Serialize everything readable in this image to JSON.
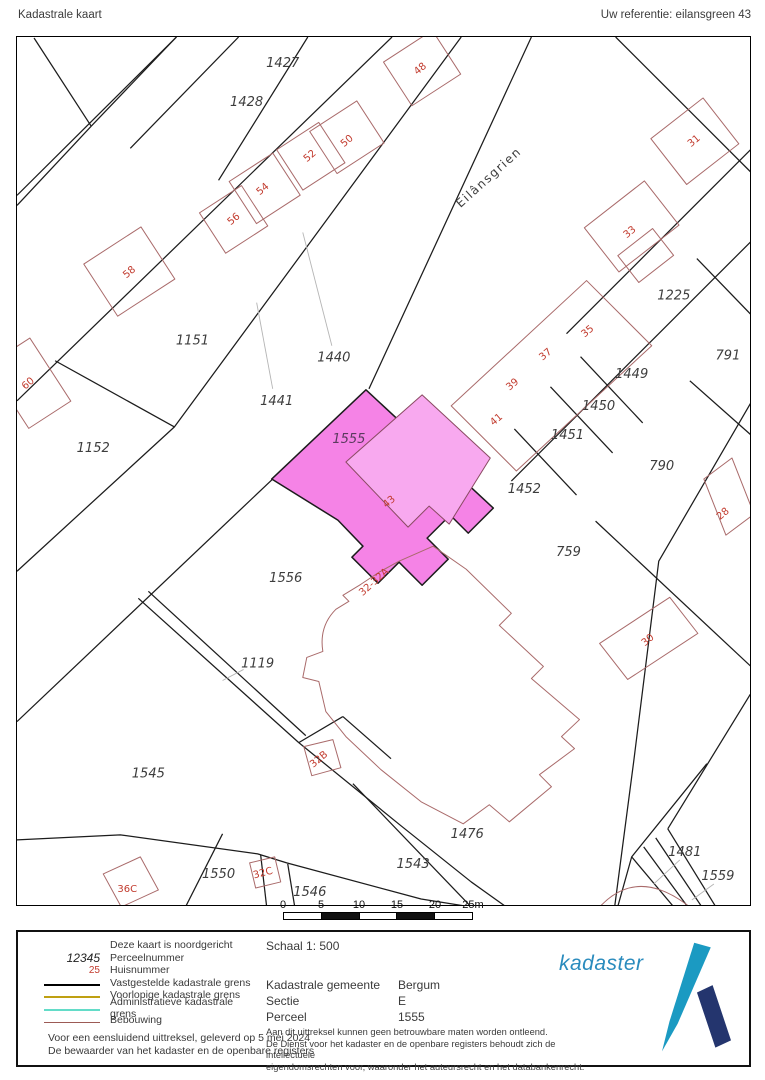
{
  "header": {
    "title": "Kadastrale kaart",
    "reference": "Uw referentie: eilansgreen 43"
  },
  "scalebar": {
    "ticks": [
      "0",
      "5",
      "10",
      "15",
      "20",
      "25m"
    ]
  },
  "legend": {
    "north_note": "Deze kaart is noordgericht",
    "perceel_sample": "12345",
    "perceel_label": "Perceelnummer",
    "huis_sample": "25",
    "huis_label": "Huisnummer",
    "line_items": [
      {
        "label": "Vastgestelde kadastrale grens",
        "color": "#000000"
      },
      {
        "label": "Voorlopige kadastrale grens",
        "color": "#bfa012"
      },
      {
        "label": "Administratieve kadastrale grens",
        "color": "#63dcc8"
      },
      {
        "label": "Bebouwing",
        "color": "#9c5a55"
      }
    ],
    "footer_line1": "Voor een eensluidend uittreksel, geleverd op 5 mei 2024",
    "footer_line2": "De bewaarder van het kadaster en de openbare registers",
    "schaal": "Schaal 1: 500",
    "info_rows": [
      {
        "label": "Kadastrale gemeente",
        "value": "Bergum"
      },
      {
        "label": "Sectie",
        "value": "E"
      },
      {
        "label": "Perceel",
        "value": "1555"
      }
    ],
    "disclaimer": [
      "Aan dit uittreksel kunnen geen betrouwbare maten worden ontleend.",
      "De Dienst voor het kadaster en de openbare registers behoudt zich de intellectuele",
      "eigendomsrechten voor, waaronder het auteursrecht en het databankenrecht."
    ],
    "logo_text": "kadaster"
  },
  "map": {
    "street": {
      "text": "Eilânsgrien",
      "x": 490,
      "y": 180,
      "rot": -42
    },
    "highlight_parcel": "1555",
    "colors": {
      "highlight_fill": "#f583e6",
      "highlight_building_fill": "#f8a9ef",
      "building_line": "#a96a6a",
      "boundary_line": "#1c1c1c",
      "house_number": "#c23b2e",
      "parcel_label": "#3d3d3d"
    },
    "parcel_labels": [
      {
        "text": "1427",
        "x": 282,
        "y": 67
      },
      {
        "text": "1428",
        "x": 246,
        "y": 106
      },
      {
        "text": "1225",
        "x": 672,
        "y": 299
      },
      {
        "text": "791",
        "x": 726,
        "y": 359
      },
      {
        "text": "1151",
        "x": 192,
        "y": 344
      },
      {
        "text": "1440",
        "x": 333,
        "y": 361
      },
      {
        "text": "1441",
        "x": 276,
        "y": 404
      },
      {
        "text": "1449",
        "x": 630,
        "y": 377
      },
      {
        "text": "1450",
        "x": 597,
        "y": 409
      },
      {
        "text": "1451",
        "x": 566,
        "y": 438
      },
      {
        "text": "1452",
        "x": 523,
        "y": 492
      },
      {
        "text": "790",
        "x": 660,
        "y": 469
      },
      {
        "text": "759",
        "x": 567,
        "y": 555
      },
      {
        "text": "1152",
        "x": 93,
        "y": 451
      },
      {
        "text": "1555",
        "x": 348,
        "y": 442,
        "cls": "sel"
      },
      {
        "text": "1556",
        "x": 285,
        "y": 581
      },
      {
        "text": "1119",
        "x": 257,
        "y": 666
      },
      {
        "text": "1545",
        "x": 148,
        "y": 776
      },
      {
        "text": "1476",
        "x": 466,
        "y": 836
      },
      {
        "text": "1543",
        "x": 412,
        "y": 866
      },
      {
        "text": "1550",
        "x": 218,
        "y": 876
      },
      {
        "text": "1546",
        "x": 309,
        "y": 894
      },
      {
        "text": "1481",
        "x": 683,
        "y": 854
      },
      {
        "text": "1559",
        "x": 716,
        "y": 878
      }
    ],
    "house_numbers": [
      {
        "text": "48",
        "x": 421,
        "y": 71,
        "rot": -40
      },
      {
        "text": "50",
        "x": 348,
        "y": 143,
        "rot": -40
      },
      {
        "text": "52",
        "x": 311,
        "y": 158,
        "rot": -40
      },
      {
        "text": "54",
        "x": 264,
        "y": 191,
        "rot": -40
      },
      {
        "text": "56",
        "x": 235,
        "y": 221,
        "rot": -40
      },
      {
        "text": "58",
        "x": 131,
        "y": 274,
        "rot": -40
      },
      {
        "text": "31",
        "x": 694,
        "y": 143,
        "rot": -40
      },
      {
        "text": "33",
        "x": 630,
        "y": 234,
        "rot": -40
      },
      {
        "text": "35",
        "x": 588,
        "y": 333,
        "rot": -40
      },
      {
        "text": "37",
        "x": 546,
        "y": 356,
        "rot": -40
      },
      {
        "text": "39",
        "x": 513,
        "y": 386,
        "rot": -40
      },
      {
        "text": "41",
        "x": 497,
        "y": 421,
        "rot": -40
      },
      {
        "text": "60",
        "x": 30,
        "y": 385,
        "rot": -40
      },
      {
        "text": "28",
        "x": 723,
        "y": 515,
        "rot": -40
      },
      {
        "text": "43",
        "x": 390,
        "y": 503,
        "rot": -40
      },
      {
        "text": "30",
        "x": 648,
        "y": 641,
        "rot": -40
      },
      {
        "text": "32-32A",
        "x": 375,
        "y": 583,
        "rot": -42
      },
      {
        "text": "32B",
        "x": 320,
        "y": 760,
        "rot": -40
      },
      {
        "text": "36C",
        "x": 127,
        "y": 890,
        "rot": 0
      },
      {
        "text": "32C",
        "x": 263,
        "y": 874,
        "rot": -15
      }
    ]
  }
}
